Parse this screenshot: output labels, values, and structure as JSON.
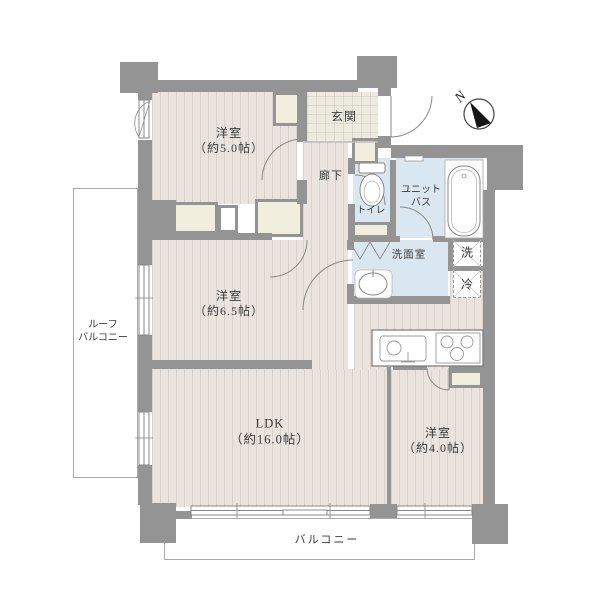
{
  "labels": {
    "room5": "洋室\n（約5.0帖）",
    "room65": "洋室\n（約6.5帖）",
    "room4": "洋室\n（約4.0帖）",
    "ldk": "LDK\n（約16.0帖）",
    "genkan": "玄関",
    "hallway": "廊下",
    "toilet": "トイレ",
    "unit_bath": "ユニット\nバス",
    "washroom": "洗面室",
    "washer": "洗",
    "fridge": "冷",
    "roof_balcony": "ルーフ\nバルコニー",
    "balcony": "バルコニー",
    "compass_north": "N"
  },
  "colors": {
    "wall": "#949494",
    "room_floor": "#ebe3de",
    "wet_floor": "#dbe7f0",
    "closet": "#f1eedd",
    "tile": "#edeadf"
  }
}
